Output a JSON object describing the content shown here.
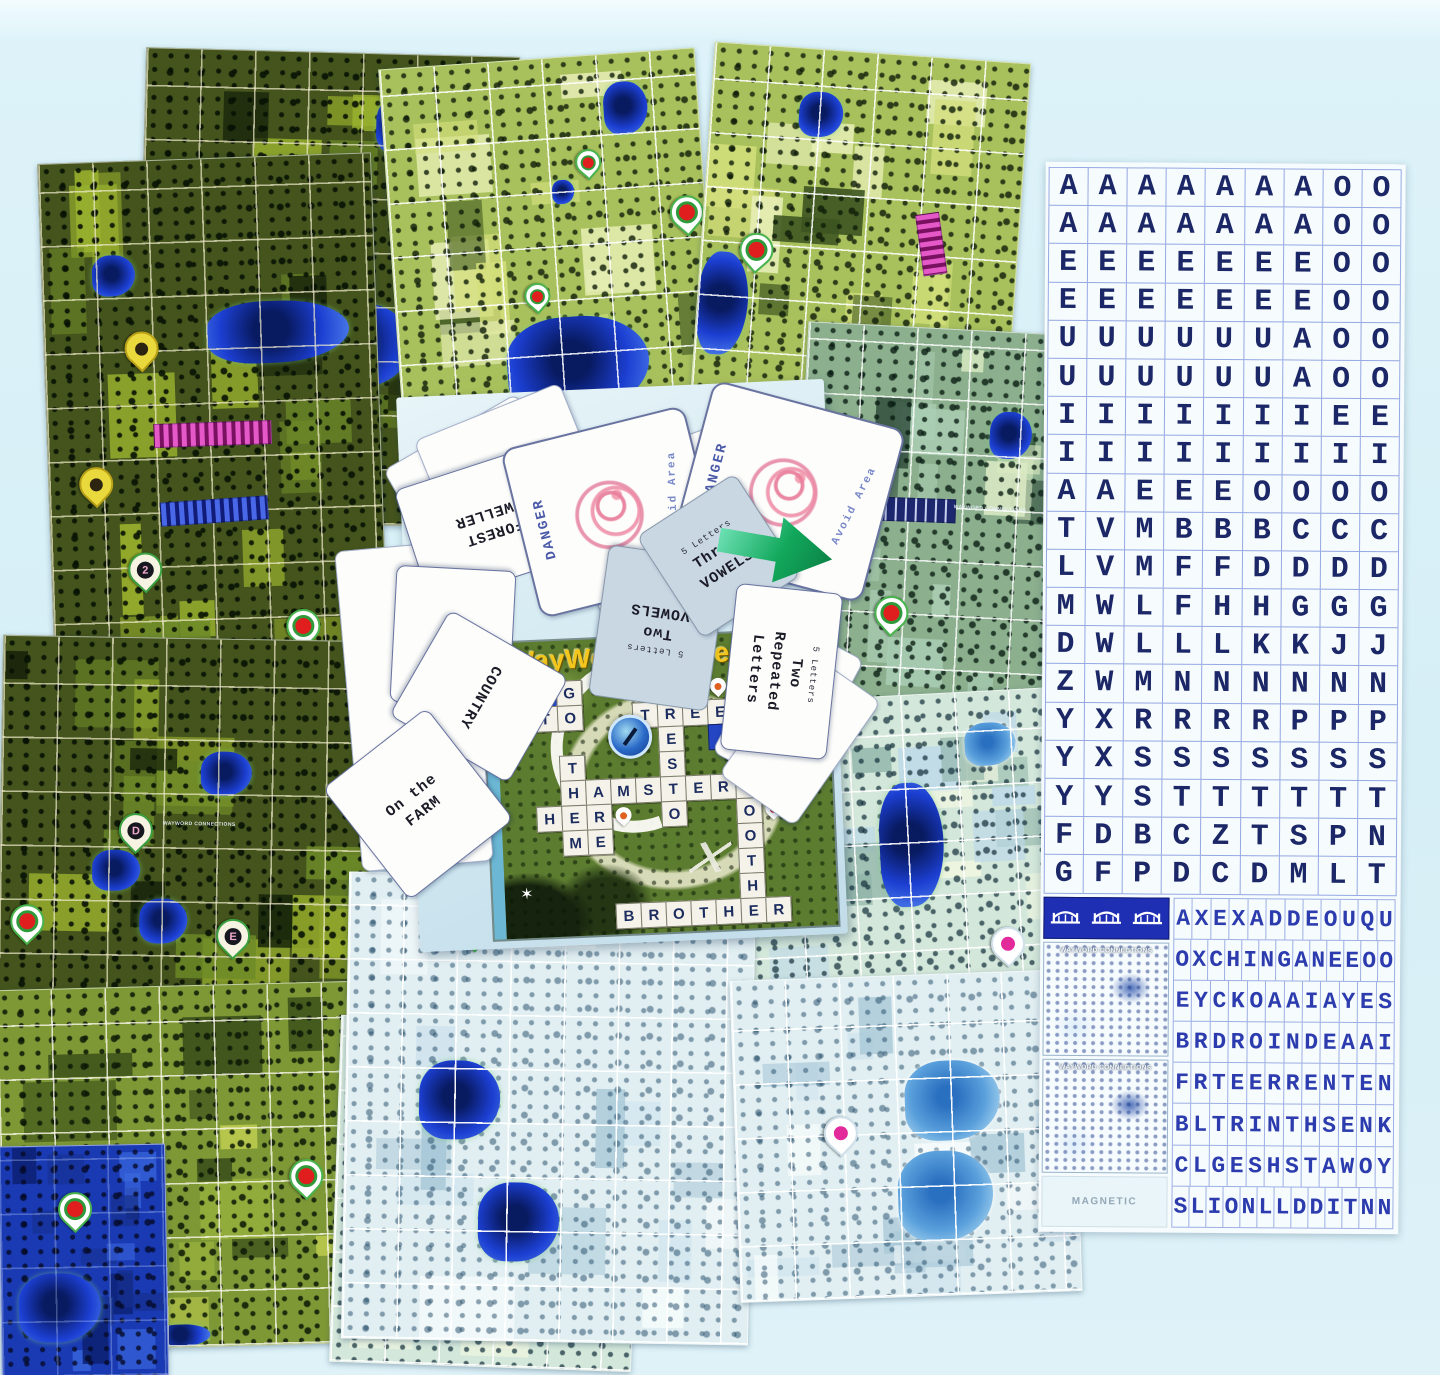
{
  "box": {
    "title": "WayWord Connections",
    "crossword_words": [
      "GO",
      "TO",
      "TREES",
      "PRESTO",
      "THEM",
      "HAMSTERS",
      "HER",
      "ARE",
      "ME",
      "SOOTHE",
      "BROTHER"
    ],
    "crossword_cells": [
      {
        "r": 1,
        "c": 2,
        "t": "blue"
      },
      {
        "r": 1,
        "c": 3,
        "t": "G"
      },
      {
        "r": 1,
        "c": 7,
        "t": "P"
      },
      {
        "r": 1,
        "c": 9,
        "t": "pin-orange"
      },
      {
        "r": 2,
        "c": 2,
        "t": "T"
      },
      {
        "r": 2,
        "c": 3,
        "t": "O"
      },
      {
        "r": 2,
        "c": 6,
        "t": "T"
      },
      {
        "r": 2,
        "c": 7,
        "t": "R"
      },
      {
        "r": 2,
        "c": 8,
        "t": "E"
      },
      {
        "r": 2,
        "c": 9,
        "t": "E"
      },
      {
        "r": 2,
        "c": 10,
        "t": "S"
      },
      {
        "r": 3,
        "c": 7,
        "t": "E"
      },
      {
        "r": 3,
        "c": 9,
        "t": "blue"
      },
      {
        "r": 3,
        "c": 10,
        "t": "blue"
      },
      {
        "r": 4,
        "c": 3,
        "t": "T"
      },
      {
        "r": 4,
        "c": 7,
        "t": "S"
      },
      {
        "r": 5,
        "c": 3,
        "t": "H"
      },
      {
        "r": 5,
        "c": 4,
        "t": "A"
      },
      {
        "r": 5,
        "c": 5,
        "t": "M"
      },
      {
        "r": 5,
        "c": 6,
        "t": "S"
      },
      {
        "r": 5,
        "c": 7,
        "t": "T"
      },
      {
        "r": 5,
        "c": 8,
        "t": "E"
      },
      {
        "r": 5,
        "c": 9,
        "t": "R"
      },
      {
        "r": 5,
        "c": 10,
        "t": "S"
      },
      {
        "r": 5,
        "c": 11,
        "t": "blue"
      },
      {
        "r": 6,
        "c": 2,
        "t": "H"
      },
      {
        "r": 6,
        "c": 3,
        "t": "E"
      },
      {
        "r": 6,
        "c": 4,
        "t": "R"
      },
      {
        "r": 6,
        "c": 5,
        "t": "pin-orange"
      },
      {
        "r": 6,
        "c": 7,
        "t": "O"
      },
      {
        "r": 6,
        "c": 10,
        "t": "O"
      },
      {
        "r": 6,
        "c": 11,
        "t": "pin-red"
      },
      {
        "r": 7,
        "c": 3,
        "t": "M"
      },
      {
        "r": 7,
        "c": 4,
        "t": "E"
      },
      {
        "r": 7,
        "c": 10,
        "t": "O"
      },
      {
        "r": 8,
        "c": 10,
        "t": "T"
      },
      {
        "r": 9,
        "c": 1,
        "t": "star"
      },
      {
        "r": 9,
        "c": 10,
        "t": "H"
      },
      {
        "r": 10,
        "c": 5,
        "t": "B"
      },
      {
        "r": 10,
        "c": 6,
        "t": "R"
      },
      {
        "r": 10,
        "c": 7,
        "t": "O"
      },
      {
        "r": 10,
        "c": 8,
        "t": "T"
      },
      {
        "r": 10,
        "c": 9,
        "t": "H"
      },
      {
        "r": 10,
        "c": 10,
        "t": "E"
      },
      {
        "r": 10,
        "c": 11,
        "t": "R"
      }
    ]
  },
  "cards": [
    {
      "name": "card-under-panel",
      "kind": "blank",
      "x": 348,
      "y": 545,
      "w": 130,
      "h": 320,
      "rot": -5
    },
    {
      "name": "card-blank-1",
      "kind": "blank",
      "x": 398,
      "y": 425,
      "w": 152,
      "h": 100,
      "rot": -30
    },
    {
      "name": "card-blank-2",
      "kind": "blank",
      "x": 427,
      "y": 408,
      "w": 155,
      "h": 100,
      "rot": -22
    },
    {
      "name": "card-forest-dweller",
      "kind": "text",
      "lines": [
        "FOREST",
        "DWELLER"
      ],
      "x": 408,
      "y": 462,
      "w": 165,
      "h": 118,
      "rot": 162
    },
    {
      "name": "card-blank-3",
      "kind": "blank",
      "x": 575,
      "y": 445,
      "w": 195,
      "h": 160,
      "rot": -20
    },
    {
      "name": "card-danger-1",
      "kind": "danger",
      "title": "DANGER",
      "subtitle": "Avoid Area",
      "x": 518,
      "y": 425,
      "w": 185,
      "h": 170,
      "rot": -14
    },
    {
      "name": "card-danger-2",
      "kind": "danger",
      "title": "DANGER",
      "subtitle": "Avoid Area",
      "x": 688,
      "y": 402,
      "w": 195,
      "h": 175,
      "rot": 15
    },
    {
      "name": "card-city",
      "kind": "text",
      "lines": [
        "CITY"
      ],
      "x": 393,
      "y": 568,
      "w": 118,
      "h": 135,
      "rot": 183
    },
    {
      "name": "card-country",
      "kind": "text",
      "lines": [
        "COUNTRY"
      ],
      "x": 418,
      "y": 628,
      "w": 120,
      "h": 135,
      "rot": 120
    },
    {
      "name": "card-on-the-farm",
      "kind": "text",
      "lines": [
        "On the",
        "FARM"
      ],
      "x": 352,
      "y": 733,
      "w": 130,
      "h": 140,
      "rot": -38
    },
    {
      "name": "card-two-vowels",
      "kind": "vowels",
      "small": "5 Letters",
      "lines": [
        "Two",
        "VOWELS"
      ],
      "x": 598,
      "y": 552,
      "w": 118,
      "h": 150,
      "rot": 188
    },
    {
      "name": "card-three-vowels",
      "kind": "vowels",
      "small": "5 Letters",
      "lines": [
        "Three",
        "VOWELS"
      ],
      "x": 660,
      "y": 495,
      "w": 115,
      "h": 120,
      "rot": -33
    },
    {
      "name": "card-blank-4",
      "kind": "blank",
      "x": 742,
      "y": 630,
      "w": 90,
      "h": 150,
      "rot": 28
    },
    {
      "name": "card-blank-5",
      "kind": "blank",
      "x": 754,
      "y": 662,
      "w": 90,
      "h": 150,
      "rot": 35
    },
    {
      "name": "card-two-repeated",
      "kind": "vowels-white",
      "small": "5 Letters",
      "lines": [
        "Two",
        "Repeated",
        "Letters"
      ],
      "x": 728,
      "y": 588,
      "w": 105,
      "h": 165,
      "rot": 6
    }
  ],
  "letter_sheet": {
    "grid_rows": [
      "AAAAAAAOO",
      "AAAAAAAOO",
      "EEEEEEEOO",
      "EEEEEEEOO",
      "UUUUUUAOO",
      "UUUUUUAOO",
      "IIIIIIIEE",
      "IIIIIIIII",
      "AAEEEOOOO",
      "TVMBBBCCC",
      "LVMFFDDDD",
      "MWLFHHGGG",
      "DWLLLKKJJ",
      "ZWMNNNNNN",
      "YXRRRRPPP",
      "YXSSSSSSS",
      "YYSTTTTTT",
      "FDBCZTSPN",
      "GFPDCDMLT"
    ],
    "bottom_rows": [
      "AXEXADDEOUQU",
      "OXCHINGANEEOO",
      "EYCKOAAIAYES",
      "BRDROINDEAAI",
      "FRTEERRENTEN",
      "BLTRINTHSENK",
      "CLGESHSTAWOY",
      "SLIONLLDDITNN"
    ],
    "bridge_count": 3,
    "mini_boxes": [
      "WAYWORD CONNECTIONS",
      "WAYWORD CONNECTIONS"
    ],
    "magnetic_label": "MAGNETIC"
  },
  "boards": [
    {
      "name": "board-top-left",
      "variant": "dark",
      "x": 140,
      "y": 52,
      "w": 372,
      "h": 470,
      "rot": 1.5,
      "small_label": "WAYWORD CONNECTIONS",
      "label_x": 18,
      "label_y": 56,
      "pins": [
        {
          "type": "letter",
          "label": "A",
          "x": 35,
          "y": 37
        },
        {
          "type": "letter",
          "label": "C",
          "x": 52,
          "y": 76
        }
      ],
      "strips": [
        {
          "color": "magenta",
          "x": 4,
          "y": 77,
          "w": 28,
          "rot": -3
        }
      ],
      "lakes": [
        {
          "x": 0,
          "y": 33,
          "w": 30,
          "h": 12
        },
        {
          "x": 45,
          "y": 53,
          "w": 28,
          "h": 18
        },
        {
          "x": 62,
          "y": 9,
          "w": 13,
          "h": 12
        }
      ]
    },
    {
      "name": "board-left",
      "variant": "dark",
      "x": 46,
      "y": 158,
      "w": 332,
      "h": 515,
      "rot": -2,
      "pins": [
        {
          "type": "yellow",
          "x": 24,
          "y": 33
        },
        {
          "type": "yellow",
          "x": 9,
          "y": 59
        },
        {
          "type": "letter",
          "label": "2",
          "x": 23,
          "y": 76
        },
        {
          "type": "target",
          "x": 70,
          "y": 88
        }
      ],
      "strips": [
        {
          "color": "magenta",
          "x": 32,
          "y": 51,
          "w": 35,
          "rot": 0
        },
        {
          "color": "blue",
          "x": 33,
          "y": 66,
          "w": 32,
          "rot": -2
        }
      ],
      "lakes": [
        {
          "x": 49,
          "y": 28,
          "w": 43,
          "h": 12
        },
        {
          "x": 15,
          "y": 18,
          "w": 13,
          "h": 8
        }
      ]
    },
    {
      "name": "board-mid-left",
      "variant": "dark",
      "x": 0,
      "y": 638,
      "w": 368,
      "h": 372,
      "rot": 1,
      "small_label": "WAYWORD CONNECTIONS",
      "label_x": 44,
      "label_y": 49,
      "pins": [
        {
          "type": "letter",
          "label": "D",
          "x": 32,
          "y": 47
        },
        {
          "type": "letter",
          "label": "E",
          "x": 59,
          "y": 75
        },
        {
          "type": "target",
          "x": 3,
          "y": 72
        }
      ],
      "strips": [],
      "lakes": [
        {
          "x": 54,
          "y": 30,
          "w": 14,
          "h": 12
        },
        {
          "x": 25,
          "y": 57,
          "w": 13,
          "h": 11
        },
        {
          "x": 38,
          "y": 70,
          "w": 13,
          "h": 12
        }
      ]
    },
    {
      "name": "board-bottom-left",
      "variant": "med",
      "x": 0,
      "y": 985,
      "w": 395,
      "h": 360,
      "rot": -1.5,
      "pins": [
        {
          "type": "target",
          "x": 73,
          "y": 49
        }
      ],
      "strips": [],
      "lakes": [
        {
          "x": 5,
          "y": 90,
          "w": 12,
          "h": 8
        },
        {
          "x": 38,
          "y": 94,
          "w": 14,
          "h": 6
        }
      ]
    },
    {
      "name": "board-corner-water",
      "variant": "water",
      "x": 0,
      "y": 1145,
      "w": 165,
      "h": 230,
      "rot": -1,
      "pins": [
        {
          "type": "target",
          "x": 35,
          "y": 20
        }
      ],
      "strips": [],
      "lakes": [
        {
          "x": 10,
          "y": 55,
          "w": 50,
          "h": 30
        }
      ]
    },
    {
      "name": "board-bottom-center-left",
      "variant": "washed",
      "x": 335,
      "y": 1020,
      "w": 300,
      "h": 345,
      "rot": 2,
      "pins": [
        {
          "type": "pink",
          "x": 47,
          "y": 16
        }
      ],
      "strips": [],
      "lakes": [
        {
          "x": 30,
          "y": 55,
          "w": 22,
          "h": 18,
          "light": true
        },
        {
          "x": 60,
          "y": 75,
          "w": 20,
          "h": 15,
          "light": true
        }
      ]
    },
    {
      "name": "board-top-center",
      "variant": "light",
      "x": 392,
      "y": 58,
      "w": 315,
      "h": 405,
      "rot": -4,
      "pins": [
        {
          "type": "target",
          "sm": true,
          "x": 60,
          "y": 23
        },
        {
          "type": "target",
          "x": 89,
          "y": 36
        },
        {
          "type": "target",
          "sm": true,
          "x": 41,
          "y": 55
        }
      ],
      "strips": [],
      "lakes": [
        {
          "x": 70,
          "y": 7,
          "w": 14,
          "h": 13
        },
        {
          "x": 34,
          "y": 64,
          "w": 45,
          "h": 24
        },
        {
          "x": 52,
          "y": 30,
          "w": 7,
          "h": 6
        }
      ]
    },
    {
      "name": "board-top-right",
      "variant": "light",
      "x": 700,
      "y": 52,
      "w": 315,
      "h": 415,
      "rot": 4,
      "pins": [
        {
          "type": "target",
          "x": 12,
          "y": 45
        },
        {
          "type": "target",
          "x": 65,
          "y": 72
        }
      ],
      "strips": [
        {
          "color": "magenta",
          "x": 63,
          "y": 42,
          "w": 19,
          "rot": 78
        }
      ],
      "lakes": [
        {
          "x": 28,
          "y": 10,
          "w": 14,
          "h": 11
        },
        {
          "x": 0,
          "y": 50,
          "w": 16,
          "h": 25
        }
      ]
    },
    {
      "name": "board-mid-right",
      "variant": "teal",
      "x": 798,
      "y": 328,
      "w": 265,
      "h": 395,
      "rot": 3,
      "small_label": "WAYWORD CONNECTIONS",
      "label_x": 58,
      "label_y": 44,
      "pins": [
        {
          "type": "target",
          "x": 30,
          "y": 68
        }
      ],
      "strips": [
        {
          "color": "navy",
          "x": 21,
          "y": 43,
          "w": 37,
          "rot": -1
        }
      ],
      "lakes": [
        {
          "x": 70,
          "y": 20,
          "w": 16,
          "h": 12
        }
      ]
    },
    {
      "name": "board-right-lower",
      "variant": "washed",
      "x": 745,
      "y": 695,
      "w": 320,
      "h": 310,
      "rot": -3,
      "pins": [
        {
          "type": "pink",
          "x": 75,
          "y": 76
        }
      ],
      "strips": [],
      "lakes": [
        {
          "x": 42,
          "y": 28,
          "w": 20,
          "h": 40
        },
        {
          "x": 70,
          "y": 10,
          "w": 16,
          "h": 14,
          "light": true
        }
      ]
    },
    {
      "name": "board-bottom-center",
      "variant": "washed2",
      "x": 345,
      "y": 875,
      "w": 405,
      "h": 465,
      "rot": 1,
      "pins": [
        {
          "type": "target",
          "x": 27,
          "y": 8
        }
      ],
      "strips": [
        {
          "color": "navy",
          "x": 47,
          "y": 8,
          "w": 32,
          "rot": -8
        }
      ],
      "lakes": [
        {
          "x": 18,
          "y": 40,
          "w": 20,
          "h": 17
        },
        {
          "x": 33,
          "y": 66,
          "w": 20,
          "h": 17
        }
      ]
    },
    {
      "name": "board-bottom-right",
      "variant": "washed2",
      "x": 735,
      "y": 975,
      "w": 340,
      "h": 320,
      "rot": -2,
      "pins": [
        {
          "type": "pink",
          "x": 26,
          "y": 43
        }
      ],
      "strips": [],
      "lakes": [
        {
          "x": 50,
          "y": 27,
          "w": 28,
          "h": 25,
          "light": true
        },
        {
          "x": 47,
          "y": 55,
          "w": 28,
          "h": 28,
          "light": true
        }
      ]
    }
  ]
}
